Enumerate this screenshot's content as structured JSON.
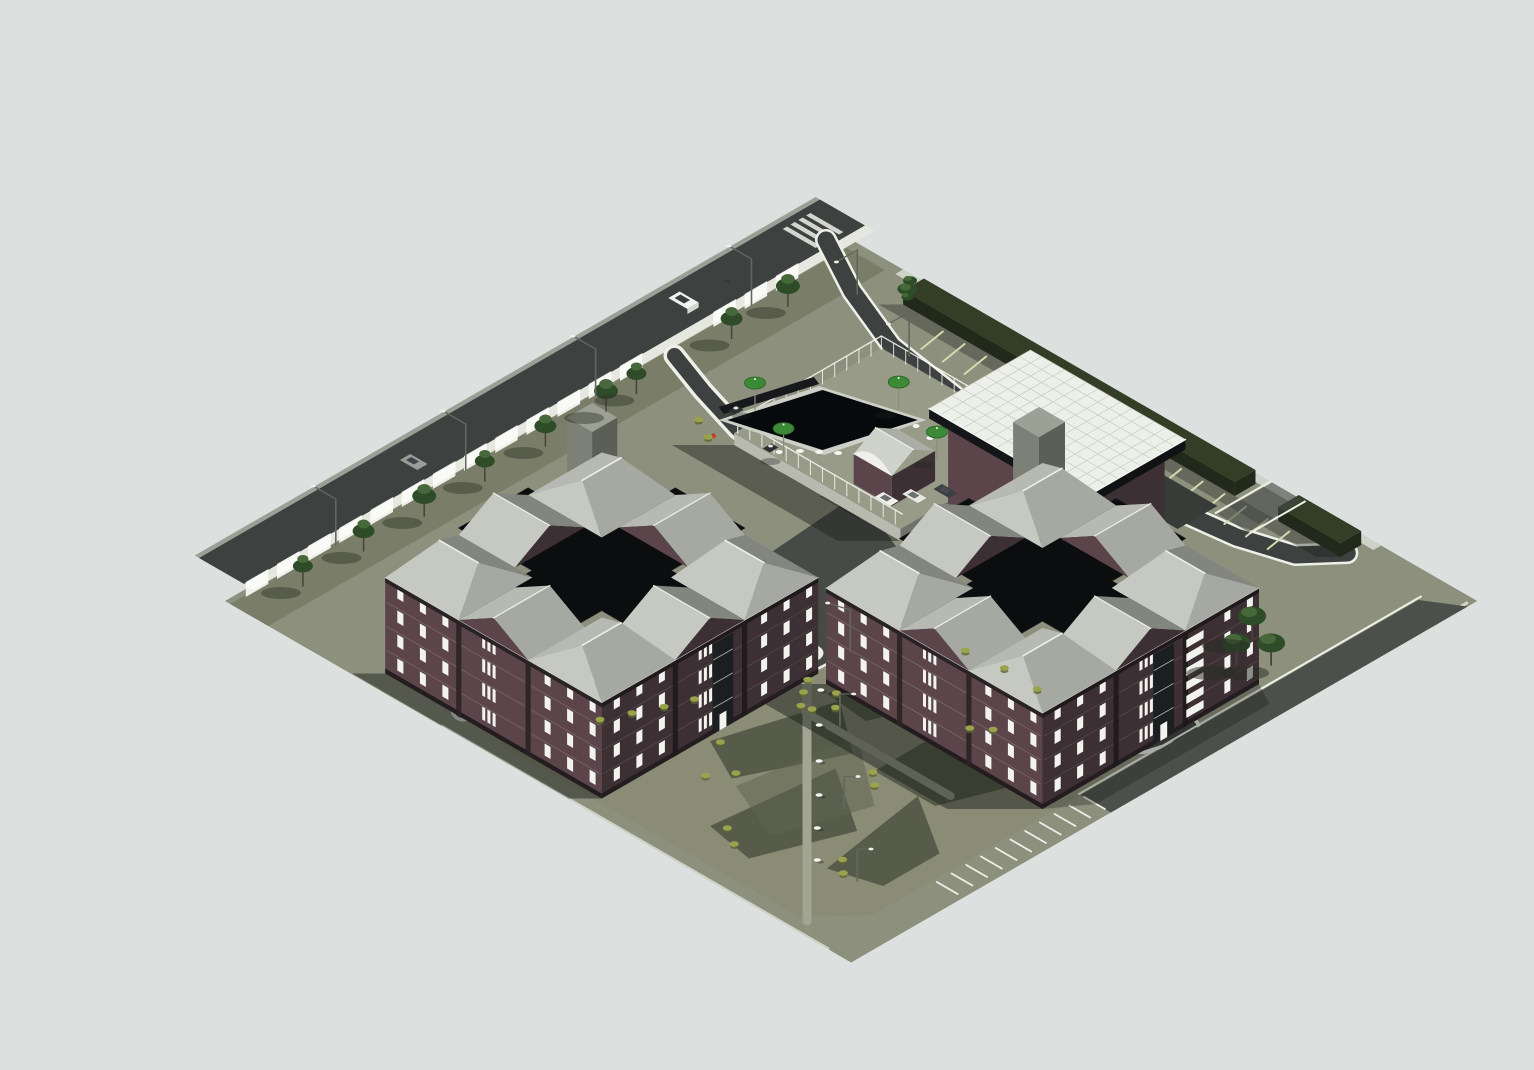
{
  "scene": {
    "description": "Isometric 3D architectural rendering of an apartment complex site plan: two cross-shaped dark-brick apartment buildings with black flat cross roofs and gray hipped wing roofs, a pool amenity deck with green umbrellas, a white grid-roof clubhouse, a perimeter street along the northwest edge, hedge-lined angled parking along the northeast edge, a curved internal drive with a white traffic circle, and a large lawn with angular tree shadows toward the south corner.",
    "view": "axonometric site render",
    "site_shape": "diamond (rotated square parcel)",
    "buildings": [
      {
        "id": "west-residential-building",
        "plan": "cross / pinwheel",
        "floors": 4,
        "facade": "dark red brick with white framed windows",
        "roof": "black flat cross core with gray hipped wing roofs and gabled arm ends",
        "features": [
          "rooftop stair tower",
          "dark glazed entry bay"
        ]
      },
      {
        "id": "east-residential-building",
        "plan": "cross / pinwheel",
        "floors": 4,
        "facade": "dark red brick with white framed windows",
        "roof": "black flat cross core with gray hipped wing roofs and gabled arm ends",
        "features": [
          "rooftop stair tower",
          "white striped stair bay",
          "attached clubhouse with white gridded roof"
        ]
      }
    ],
    "amenities": {
      "swimming_pool": 1,
      "pool_umbrellas": 4,
      "pool_cabana_barrel_roof": 1,
      "clubhouse_grid_roof": 1,
      "pool_deck_fence": true
    },
    "circulation": {
      "perimeter_street_nw": 1,
      "internal_drive": true,
      "traffic_circle": 1,
      "courtyard_plaza": 1,
      "angled_parking_rows_ne": 2,
      "parking_stalls_se": 11,
      "crosswalk_north_corner": 1
    },
    "landscape": {
      "street_trees_nw": 9,
      "corner_trees_se": 3,
      "hedge_ne_edge": true,
      "lawn_with_tree_shadows": true,
      "shrub_clusters": 26,
      "lawn_benches": 6,
      "lawn_walkways": 2,
      "street_lamps": 10
    },
    "vehicles": {
      "cars_on_street": 2,
      "cars_at_plaza": 3
    }
  },
  "palette": {
    "bg": "#dce1df",
    "ground": "#8e907e",
    "grass": "#7a7e69",
    "lawn": "#8a8c76",
    "lawnShadow": "#4a5040",
    "road": "#3d4140",
    "plaza": "#474b47",
    "sidewalk": "#e6e8df",
    "curb": "#eef0e8",
    "stripeWhite": "#eef0e8",
    "stripePale": "#d6dab0",
    "hedge": "#333e27",
    "hedgeDark": "#20291a",
    "brickLit": "#5b454b",
    "brickShade": "#3d3034",
    "brickDark": "#2a2225",
    "base": "#241d20",
    "roofBlack": "#0b0d0f",
    "roofLight": "#c6c9c1",
    "roofLight2": "#b7bab2",
    "roofMid": "#a5a9a1",
    "roofDark": "#82867f",
    "ridge": "#eff0eb",
    "clubRoof": "#edefe9",
    "clubGrid": "#c7cac1",
    "glass": "#1b1f22",
    "windowWhite": "#f2f3ee",
    "pool": "#07090c",
    "poolCoping": "#ccd0c6",
    "umbrella": "#3d8a36",
    "umbrellaDark": "#27611f",
    "bush": "#9aa24b",
    "bushDark": "#5c6531",
    "treeDark": "#2f4c28",
    "treeLight": "#47683a",
    "trunk": "#4c4138",
    "towerLit": "#7c8076",
    "towerShade": "#5b5f56",
    "towerTop": "#9da195",
    "lamp": "#62665e",
    "white": "#f4f5f1",
    "hydrant": "#c23b28",
    "shadow": "#1c201a"
  }
}
